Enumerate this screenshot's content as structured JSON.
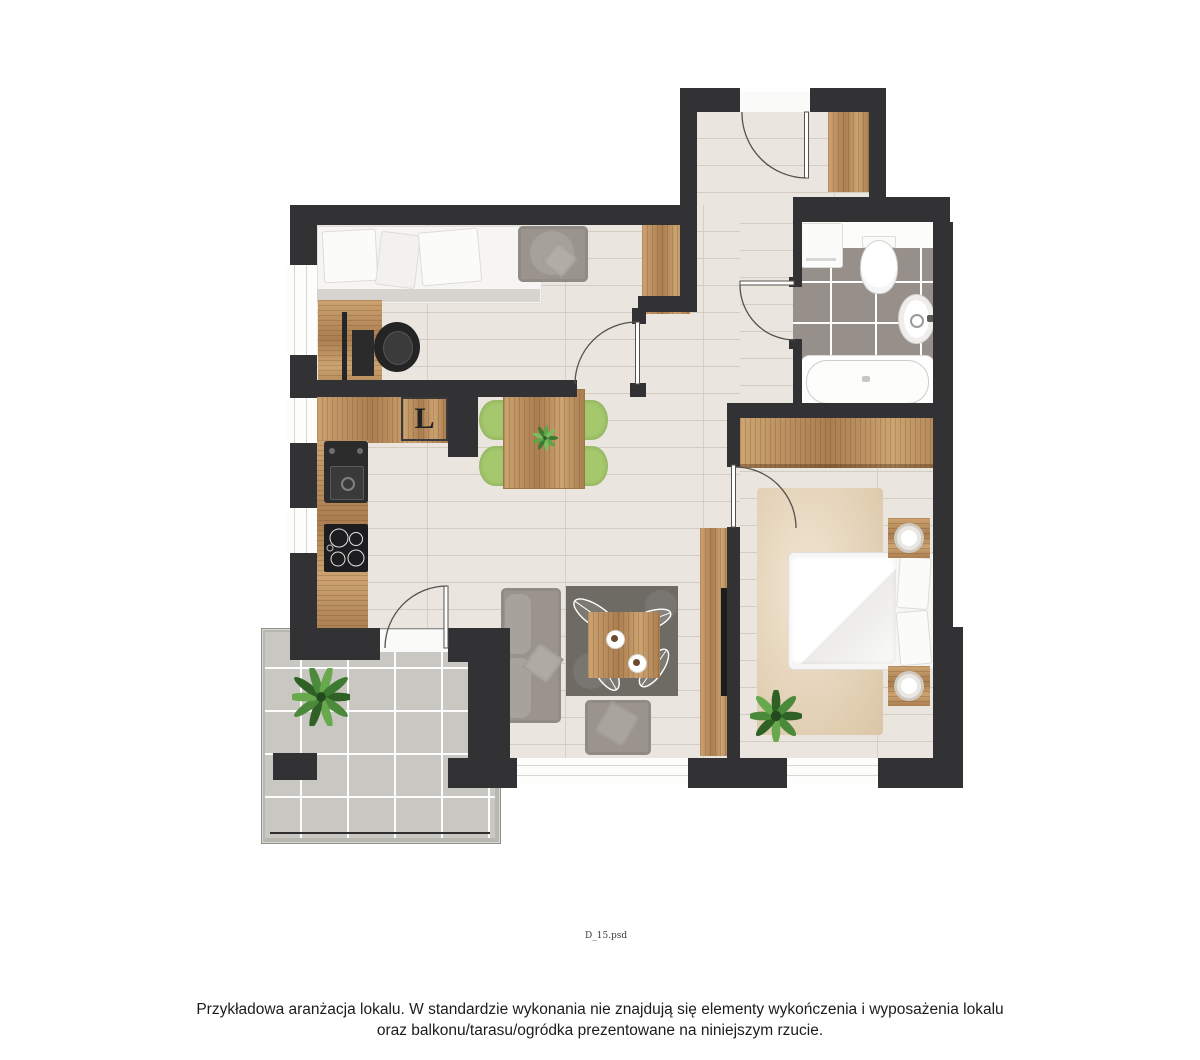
{
  "plan": {
    "kitchen": {
      "fridge_label": "L"
    },
    "file_label": "D_15.psd"
  },
  "footer": {
    "line1": "Przykładowa aranżacja lokalu. W standardzie wykonania nie znajdują się elementy wykończenia i wyposażenia lokalu",
    "line2": "oraz balkonu/tarasu/ogródka prezentowane na niniejszym rzucie."
  },
  "colors": {
    "wall": "#323133",
    "wood_floor": "#eae6df",
    "plank_line": "#d2ccc1",
    "cabinet_light": "#cda371",
    "cabinet_dark": "#aa7e50",
    "bath_tile": "#97908a",
    "terrace_tile": "#c9c7c2",
    "grout": "#ffffff",
    "chair_green": "#a5c86d",
    "sofa_gray": "#9b948e",
    "rug_living": "#6e6a64",
    "rug_bedroom": "#e6d0ae",
    "door_line": "#55514d",
    "text": "#1c1c1c"
  }
}
